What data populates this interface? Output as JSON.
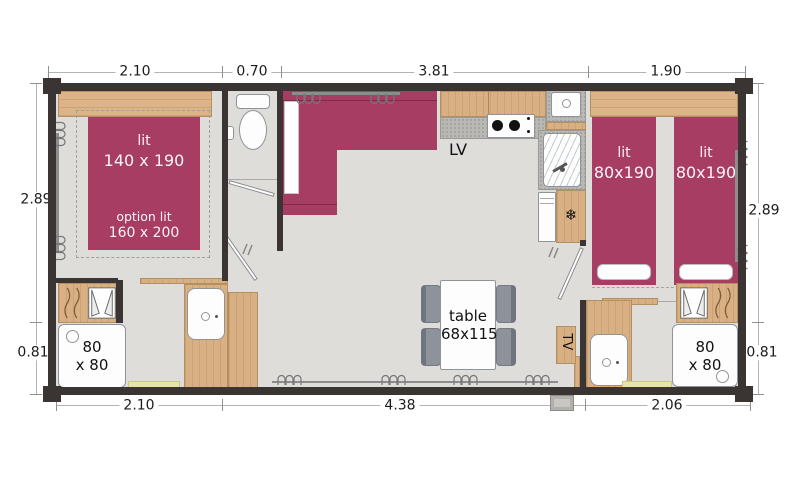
{
  "plan_type": "floor-plan",
  "colors": {
    "wall": "#3a3433",
    "floor": "#deddda",
    "accent_magenta": "#a73d63",
    "wood": "#d8b083",
    "granite": "#bab8b5",
    "doormat_yellow": "#e5e5a7",
    "chair_gray": "#8d929b"
  },
  "dims": {
    "top": [
      "2.10",
      "0.70",
      "3.81",
      "1.90"
    ],
    "bottom": [
      "2.10",
      "4.38",
      "2.06"
    ],
    "left": [
      "2.89",
      "0.81"
    ],
    "right": [
      "2.89",
      "0.81"
    ]
  },
  "labels": {
    "master_bed_name": "lit",
    "master_bed_size": "140 x 190",
    "option_bed_name": "option lit",
    "option_bed_size": "160 x 200",
    "twin_bed1_name": "lit",
    "twin_bed1_size": "80x190",
    "twin_bed2_name": "lit",
    "twin_bed2_size": "80x190",
    "dishwasher": "LV",
    "table_name": "table",
    "table_size": "68x115",
    "tv": "TV",
    "shower_left_line1": "80",
    "shower_left_line2": "x 80",
    "shower_right_line1": "80",
    "shower_right_line2": "x 80",
    "freezer_icon_glyph": "❄"
  }
}
